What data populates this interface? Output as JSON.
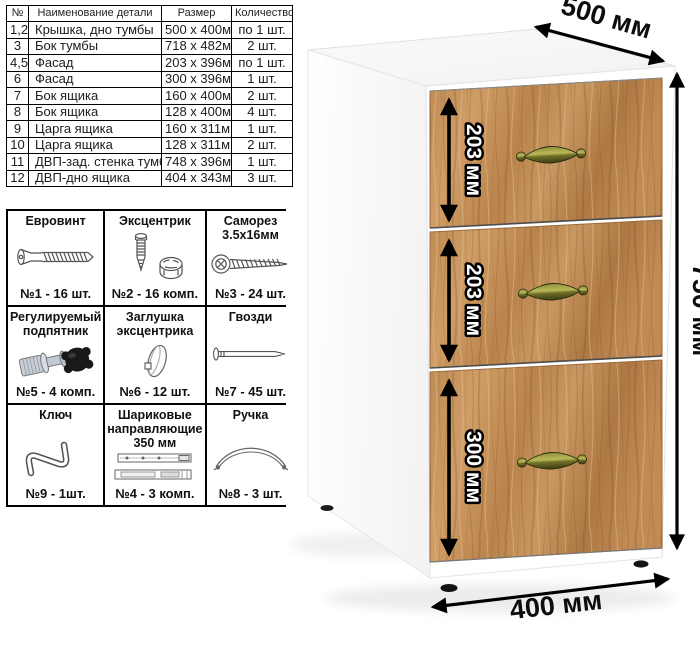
{
  "parts_table": {
    "headers": [
      "№",
      "Наименование детали",
      "Размер",
      "Количество"
    ],
    "rows": [
      {
        "num": "1,2",
        "name": "Крышка, дно тумбы",
        "size": "500 х 400мм",
        "qty": "по 1 шт."
      },
      {
        "num": "3",
        "name": "Бок тумбы",
        "size": "718 х 482мм",
        "qty": "2 шт."
      },
      {
        "num": "4,5",
        "name": "Фасад",
        "size": "203 х 396мм",
        "qty": "по 1 шт."
      },
      {
        "num": "6",
        "name": "Фасад",
        "size": "300 х 396мм",
        "qty": "1 шт."
      },
      {
        "num": "7",
        "name": "Бок ящика",
        "size": "160 х 400мм",
        "qty": "2 шт."
      },
      {
        "num": "8",
        "name": "Бок ящика",
        "size": "128 х 400мм",
        "qty": "4 шт."
      },
      {
        "num": "9",
        "name": "Царга ящика",
        "size": "160 х 311мм",
        "qty": "1 шт."
      },
      {
        "num": "10",
        "name": "Царга ящика",
        "size": "128 х 311мм",
        "qty": "2 шт."
      },
      {
        "num": "11",
        "name": "ДВП-зад. стенка тумбы",
        "size": "748 х 396мм",
        "qty": "1 шт."
      },
      {
        "num": "12",
        "name": "ДВП-дно ящика",
        "size": "404 х 343мм",
        "qty": "3 шт."
      }
    ]
  },
  "hardware_table": {
    "cells": [
      {
        "title": "Евровинт",
        "icon": "euro-screw-icon",
        "count": "№1 - 16 шт."
      },
      {
        "title": "Эксцентрик",
        "icon": "cam-lock-icon",
        "count": "№2 - 16 комп."
      },
      {
        "title": "Саморез 3.5х16мм",
        "icon": "self-tapping-screw-icon",
        "count": "№3 - 24 шт."
      },
      {
        "title": "Регулируемый подпятник",
        "icon": "adjustable-foot-icon",
        "count": "№5 - 4 комп."
      },
      {
        "title": "Заглушка эксцентрика",
        "icon": "cam-cover-icon",
        "count": "№6 - 12 шт."
      },
      {
        "title": "Гвозди",
        "icon": "nails-icon",
        "count": "№7 - 45 шт."
      },
      {
        "title": "Ключ",
        "icon": "hex-key-icon",
        "count": "№9 - 1шт."
      },
      {
        "title": "Шариковые направляющие 350 мм",
        "icon": "ball-slides-icon",
        "count": "№4 - 3 комп."
      },
      {
        "title": "Ручка",
        "icon": "drawer-handle-icon",
        "count": "№8 - 3 шт."
      }
    ]
  },
  "cabinet": {
    "dimensions": {
      "depth": "500 мм",
      "height": "750 мм",
      "width": "400 мм",
      "drawer1": "203 мм",
      "drawer2": "203 мм",
      "drawer3": "300 мм"
    },
    "colors": {
      "carcass": "#ffffff",
      "wood_mid": "#c08b55",
      "wood_dark": "#9c6b3c",
      "wood_light": "#d2a168",
      "handle_brass": "#7c7c30",
      "dimension_text": "#0d0d0d"
    }
  }
}
